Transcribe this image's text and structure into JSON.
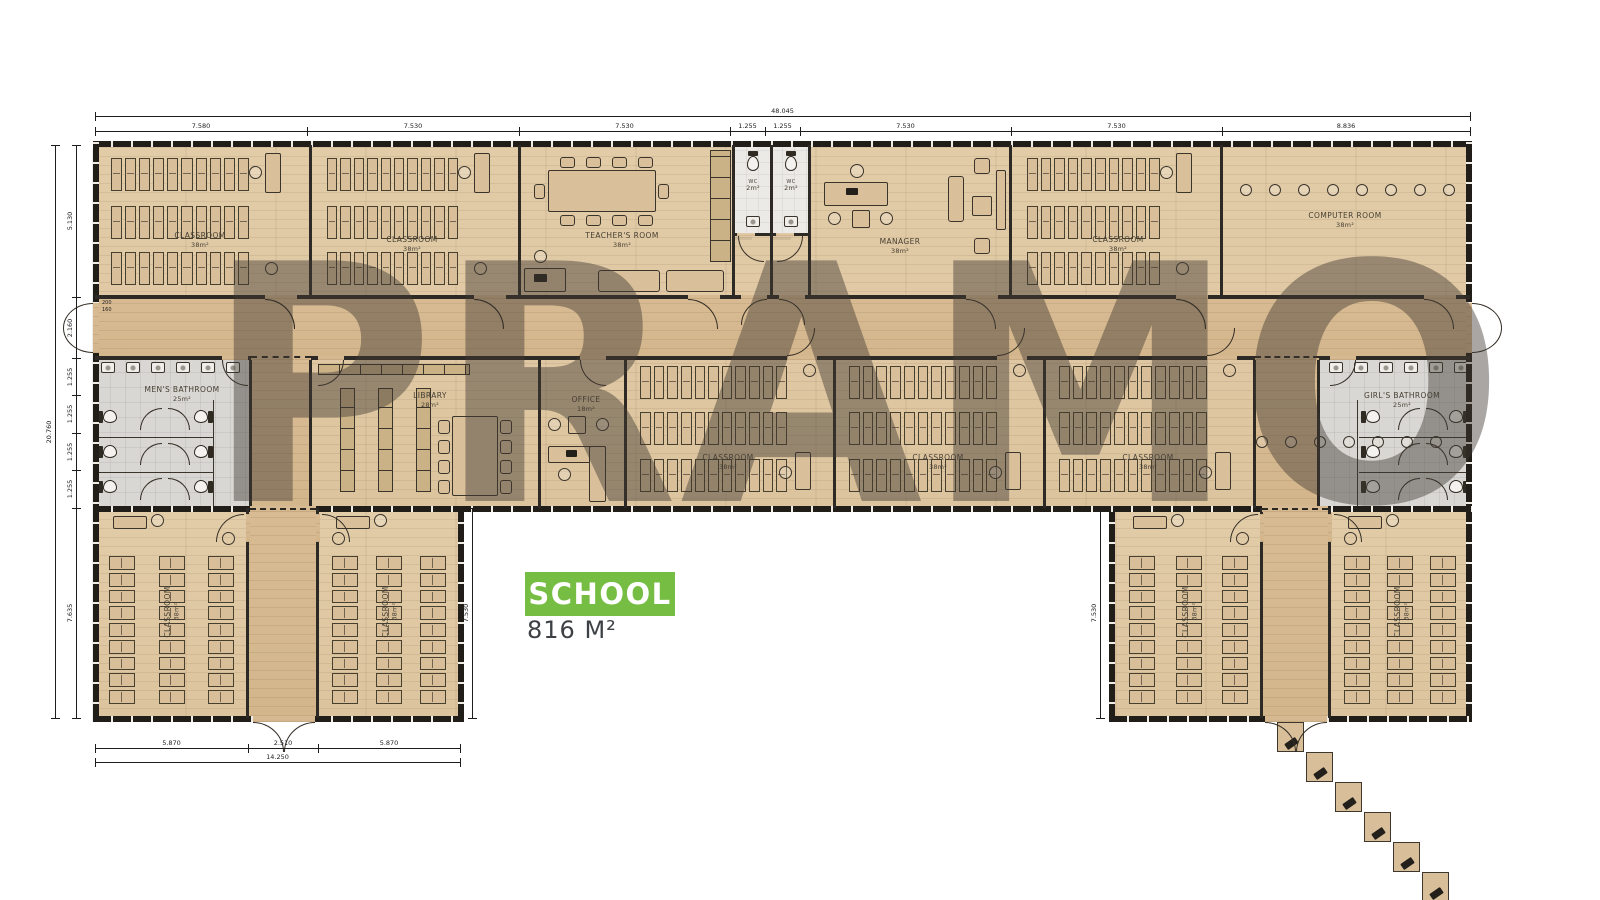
{
  "watermark": "PRAMO",
  "badge": {
    "label": "SCHOOL",
    "area": "816 M²"
  },
  "colors": {
    "accent": "#76bd43",
    "wall": "#2b2722",
    "floor": "#e0c9a6",
    "corridor": "#d7ba92",
    "bathroom": "#d8d6d2",
    "watermark": "rgba(64,57,50,0.45)"
  },
  "rooms": [
    {
      "id": "classroom-1",
      "name": "CLASSROOM",
      "area": "38m²"
    },
    {
      "id": "classroom-2",
      "name": "CLASSROOM",
      "area": "38m²"
    },
    {
      "id": "teachers-room",
      "name": "TEACHER'S ROOM",
      "area": "38m²"
    },
    {
      "id": "wc-1",
      "name": "WC",
      "area": "2m²"
    },
    {
      "id": "wc-2",
      "name": "WC",
      "area": "2m²"
    },
    {
      "id": "manager",
      "name": "MANAGER",
      "area": "38m²"
    },
    {
      "id": "classroom-3",
      "name": "CLASSROOM",
      "area": "38m²"
    },
    {
      "id": "computer-room",
      "name": "COMPUTER ROOM",
      "area": "38m²"
    },
    {
      "id": "mens-bathroom",
      "name": "MEN'S BATHROOM",
      "area": "25m²"
    },
    {
      "id": "library",
      "name": "LIBRARY",
      "area": "28m²"
    },
    {
      "id": "office",
      "name": "OFFICE",
      "area": "18m²"
    },
    {
      "id": "classroom-4",
      "name": "CLASSROOM",
      "area": "38m²"
    },
    {
      "id": "classroom-5",
      "name": "CLASSROOM",
      "area": "38m²"
    },
    {
      "id": "classroom-6",
      "name": "CLASSROOM",
      "area": "38m²"
    },
    {
      "id": "girls-bathroom",
      "name": "GIRL'S BATHROOM",
      "area": "25m²"
    },
    {
      "id": "wing-classroom-1",
      "name": "CLASSROOM",
      "area": "38m²"
    },
    {
      "id": "wing-classroom-2",
      "name": "CLASSROOM",
      "area": "38m²"
    },
    {
      "id": "wing-classroom-3",
      "name": "CLASSROOM",
      "area": "38m²"
    },
    {
      "id": "wing-classroom-4",
      "name": "CLASSROOM",
      "area": "38m²"
    }
  ],
  "dimensions": {
    "top_total": "48.045",
    "top_segments": [
      "7.580",
      "7.530",
      "7.530",
      "1.255",
      "1.255",
      "7.530",
      "7.530",
      "8.836"
    ],
    "left_total": "20.760",
    "left_segments": [
      "5.130",
      "2.160",
      "1.255",
      "1.255",
      "1.255",
      "1.255",
      "7.635"
    ],
    "bottom_left_segments": [
      "5.870",
      "2.510",
      "5.870"
    ],
    "bottom_left_total": "14.250",
    "left_wing_height": "7.530",
    "right_wing_height": "7.530",
    "entry_door_width": "200",
    "entry_door_offset": "160"
  }
}
